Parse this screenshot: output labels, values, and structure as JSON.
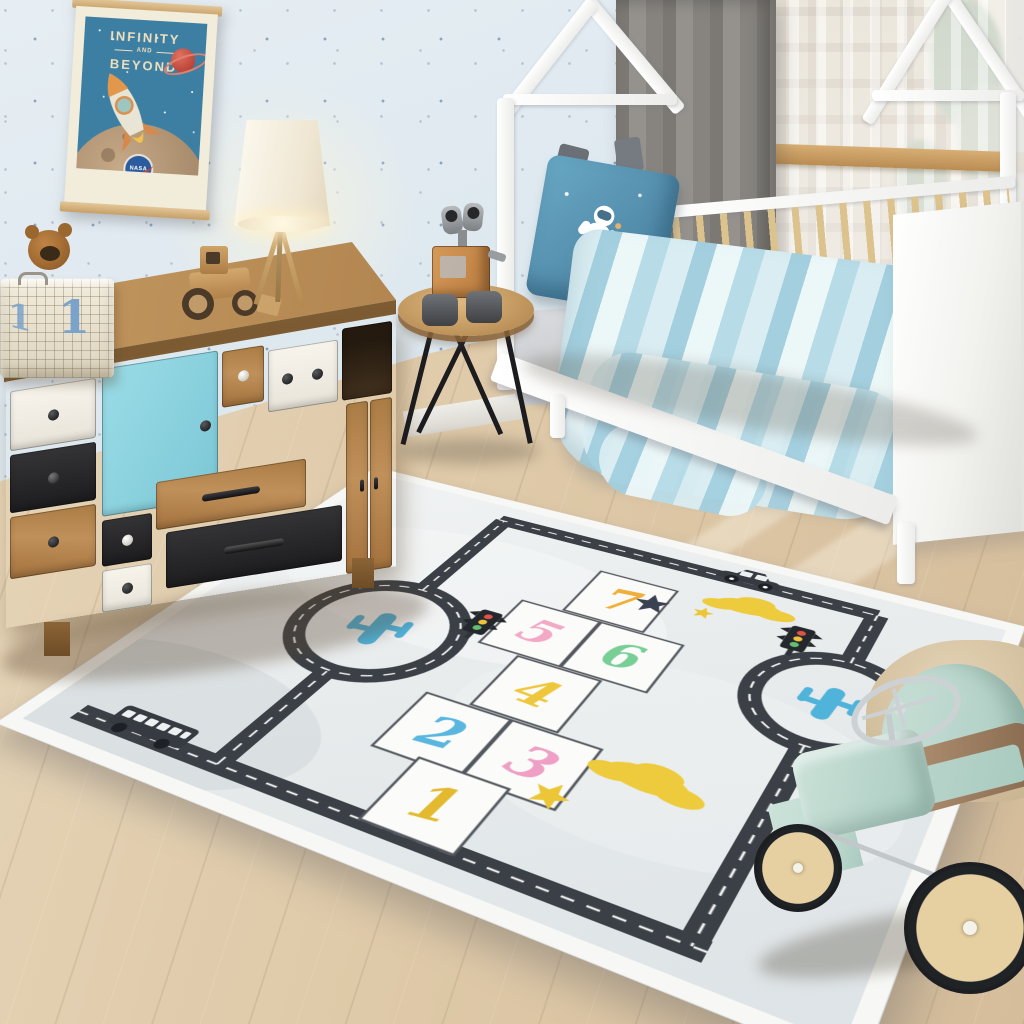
{
  "room": {
    "description": "Kids bedroom with hopscotch road play rug",
    "palette": {
      "wall": "#d8e4ec",
      "floor": "#dfcaa9",
      "curtain": "#87847f",
      "bed_frame": "#f4f4f2",
      "dresser_wood": "#a87a46",
      "dresser_blue_door": "#8ed2df",
      "toycar_mint": "#bcd8cf",
      "bedding_blue": "#a3cfdf"
    }
  },
  "poster": {
    "title1": "INFINITY",
    "title2": "AND",
    "title3": "BEYOND",
    "badge": "NASA",
    "background": "#3d7ea3",
    "icons": [
      "rocket-icon",
      "ringed-planet-icon",
      "moon-icon",
      "stars-icon",
      "nasa-badge-icon"
    ]
  },
  "basket": {
    "number": "1",
    "contents": "teddy-bear"
  },
  "rug": {
    "style": "hopscotch road play rug",
    "base_color": "#ecefef",
    "road_color": "#3b4046",
    "squares": [
      {
        "label": "1",
        "color": "#e3b92e"
      },
      {
        "label": "2",
        "color": "#58b6df"
      },
      {
        "label": "3",
        "color": "#ef9fc4"
      },
      {
        "label": "4",
        "color": "#eec73c"
      },
      {
        "label": "5",
        "color": "#f2a9c6"
      },
      {
        "label": "6",
        "color": "#77cf96"
      },
      {
        "label": "7",
        "color": "#f1ae3a"
      }
    ],
    "icons": [
      "cactus-icon",
      "cactus-icon",
      "traffic-light-icon",
      "traffic-light-icon",
      "car-icon",
      "bus-icon",
      "cloud-icon",
      "cloud-icon",
      "star-icon-navy",
      "star-icon-yellow",
      "star-icon-yellow"
    ],
    "cactus_color": "#4fb3da",
    "cloud_color": "#eecb3d",
    "star_navy": "#3a4150",
    "star_yellow": "#ecc636"
  },
  "toys": [
    "wall-e-robot",
    "wooden-tractor",
    "teddy-bear",
    "ride-on-car"
  ],
  "furniture": [
    "patchwork-dresser",
    "tripod-lamp",
    "round-side-table",
    "house-frame-bed"
  ]
}
